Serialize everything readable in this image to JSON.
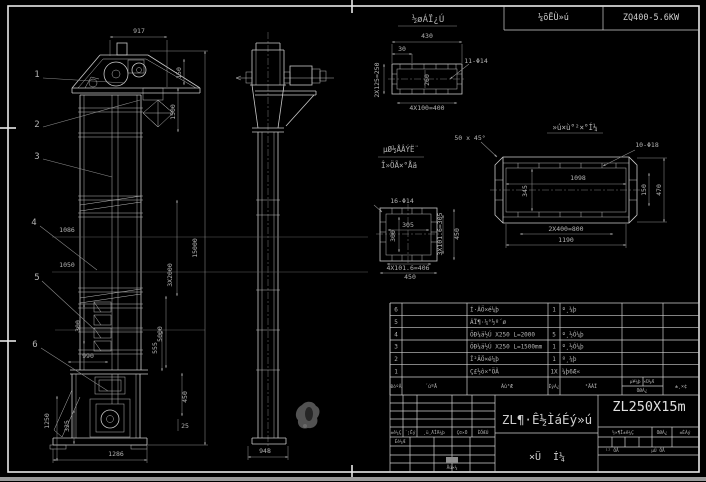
{
  "colors": {
    "background": "#000000",
    "frame": "#e8e8e8",
    "line": "#c9c9c9",
    "dim_line": "#8d8d8d",
    "text": "#b3b3b3",
    "accent_text": "#d9d9d9",
    "strip": "#9a9a9a",
    "blob": "#525252"
  },
  "header": {
    "reducer_label": "¼õËÙ»ú",
    "reducer_model": "ZQ400-5.6KW"
  },
  "view_titles": [
    {
      "t": "½øÁÏ¿Ú",
      "x": 428,
      "y": 22,
      "s": 9,
      "n": "detail-a-title"
    },
    {
      "t": "»ú×ù°²×°Í¼",
      "x": 575,
      "y": 130,
      "s": 7.5,
      "n": "detail-b-title"
    },
    {
      "t": "µØ½ÅÂÝË¨",
      "x": 401,
      "y": 152,
      "s": 7.5,
      "n": "detail-c-note-line1"
    },
    {
      "t": "Î»ÖÃ×°Åä",
      "x": 399,
      "y": 168,
      "s": 7.5,
      "n": "detail-c-note-line2"
    }
  ],
  "hole_notes": [
    {
      "t": "11-Φ14",
      "x": 476,
      "y": 63
    },
    {
      "t": "10-Φ18",
      "x": 647,
      "y": 147
    },
    {
      "t": "16-Φ14",
      "x": 402,
      "y": 203
    },
    {
      "t": "50 x 45°",
      "x": 470,
      "y": 140
    }
  ],
  "callouts": [
    {
      "t": "1",
      "x": 37,
      "y": 77
    },
    {
      "t": "2",
      "x": 37,
      "y": 127
    },
    {
      "t": "3",
      "x": 37,
      "y": 159
    },
    {
      "t": "4",
      "x": 34,
      "y": 225
    },
    {
      "t": "5",
      "x": 37,
      "y": 280
    },
    {
      "t": "6",
      "x": 35,
      "y": 347
    }
  ],
  "dimensions": [
    {
      "t": "917",
      "x": 139,
      "y": 33
    },
    {
      "t": "150",
      "x": 181,
      "y": 73,
      "r": -90
    },
    {
      "t": "1500",
      "x": 175,
      "y": 112,
      "r": -90
    },
    {
      "t": "15000",
      "x": 197,
      "y": 248,
      "r": -90
    },
    {
      "t": "3X2000",
      "x": 172,
      "y": 275,
      "r": -90
    },
    {
      "t": "5000",
      "x": 162,
      "y": 334,
      "r": -90
    },
    {
      "t": "1086",
      "x": 67,
      "y": 232
    },
    {
      "t": "1050",
      "x": 67,
      "y": 267
    },
    {
      "t": "990",
      "x": 88,
      "y": 358
    },
    {
      "t": "300",
      "x": 80,
      "y": 326,
      "r": -90
    },
    {
      "t": "1250",
      "x": 49,
      "y": 421,
      "r": -90
    },
    {
      "t": "325",
      "x": 69,
      "y": 426,
      "r": -90
    },
    {
      "t": "1286",
      "x": 116,
      "y": 456
    },
    {
      "t": "555",
      "x": 157,
      "y": 348,
      "r": -90
    },
    {
      "t": "450",
      "x": 187,
      "y": 397,
      "r": -90
    },
    {
      "t": "25",
      "x": 185,
      "y": 428
    },
    {
      "t": "948",
      "x": 265,
      "y": 453
    },
    {
      "t": "430",
      "x": 427,
      "y": 38
    },
    {
      "t": "30",
      "x": 402,
      "y": 51
    },
    {
      "t": "2X125=250",
      "x": 379,
      "y": 80,
      "r": -90
    },
    {
      "t": "260",
      "x": 429,
      "y": 80,
      "r": -90
    },
    {
      "t": "4X100=400",
      "x": 427,
      "y": 110
    },
    {
      "t": "1098",
      "x": 578,
      "y": 180
    },
    {
      "t": "345",
      "x": 527,
      "y": 191,
      "r": -90
    },
    {
      "t": "150",
      "x": 646,
      "y": 190,
      "r": -90
    },
    {
      "t": "470",
      "x": 661,
      "y": 190,
      "r": -90
    },
    {
      "t": "2X400=800",
      "x": 566,
      "y": 231
    },
    {
      "t": "1190",
      "x": 566,
      "y": 242
    },
    {
      "t": "305",
      "x": 408,
      "y": 227
    },
    {
      "t": "300",
      "x": 395,
      "y": 236,
      "r": -90
    },
    {
      "t": "3X101.6=305",
      "x": 442,
      "y": 234,
      "r": -90
    },
    {
      "t": "450",
      "x": 459,
      "y": 234,
      "r": -90
    },
    {
      "t": "4X101.6=406",
      "x": 408,
      "y": 270
    },
    {
      "t": "450",
      "x": 410,
      "y": 279
    }
  ],
  "bom": {
    "layout": {
      "left": 390,
      "right": 699,
      "top": 303,
      "header_top": 377,
      "bottom": 395,
      "cols": [
        390,
        402,
        467,
        548,
        560,
        622,
        663,
        699
      ],
      "weight_split_x": 643,
      "weight_split_y": 386,
      "no_x": 396,
      "name_x": 470,
      "qty_x": 554,
      "mat_x": 562
    },
    "headers": [
      {
        "t": "ÐòºÅ",
        "x": 396,
        "y": 388,
        "s": 4.5
      },
      {
        "t": "´úºÅ",
        "x": 431,
        "y": 388,
        "s": 5
      },
      {
        "t": "Ãû³Æ",
        "x": 507,
        "y": 388,
        "s": 5
      },
      {
        "t": "ÊýÁ¿",
        "x": 554,
        "y": 388,
        "s": 4.5
      },
      {
        "t": "²ÄÁÏ",
        "x": 591,
        "y": 388,
        "s": 5
      },
      {
        "t": "µ¥¼þ ×Ü¼Æ",
        "x": 642,
        "y": 383,
        "s": 4.5
      },
      {
        "t": "ÖØÁ¿",
        "x": 642,
        "y": 392,
        "s": 4.5
      },
      {
        "t": "±¸×¢",
        "x": 681,
        "y": 388,
        "s": 5
      }
    ],
    "rows": [
      {
        "no": "6",
        "code": "",
        "name": "Í·ÂÖ×é¼þ",
        "qty": "1",
        "mat": "º¸¼þ"
      },
      {
        "no": "5",
        "code": "",
        "name": "ÁÏ¶·¼°½º´ø",
        "qty": "",
        "mat": ""
      },
      {
        "no": "4",
        "code": "",
        "name": "ÖÐ¼ä½Ú X250 L=2000",
        "qty": "5",
        "mat": "º¸½Ó¼þ"
      },
      {
        "no": "3",
        "code": "",
        "name": "ÖÐ¼ä½Ú X250 L=1500mm",
        "qty": "1",
        "mat": "º¸½Ó¼þ"
      },
      {
        "no": "2",
        "code": "",
        "name": "Î²ÂÖ×é¼þ",
        "qty": "1",
        "mat": "º¸¼þ"
      },
      {
        "no": "1",
        "code": "",
        "name": "Ç£½ô×°ÖÃ",
        "qty": "1X",
        "mat": "¼þ6Æ«"
      }
    ]
  },
  "titleblock": {
    "machine_name": "ZL¶·Ê½ÌáÉý»ú",
    "model": "ZL250X15m",
    "drawing_type": "×Ü  Í¼",
    "labels": [
      {
        "t": "±ê¼Ç",
        "x": 396,
        "y": 434,
        "s": 4.5
      },
      {
        "t": "´¦Êý",
        "x": 410,
        "y": 434,
        "s": 4.5
      },
      {
        "t": "¸ü¸ÄÎÄ¼þ",
        "x": 434,
        "y": 434,
        "s": 4.5
      },
      {
        "t": "Ç©×Ö",
        "x": 462,
        "y": 434,
        "s": 4.5
      },
      {
        "t": "ÈÕÆÚ",
        "x": 483,
        "y": 434,
        "s": 4.5
      },
      {
        "t": "Éè¼Æ",
        "x": 400,
        "y": 443,
        "s": 4.5
      },
      {
        "t": "Åú×¼",
        "x": 452,
        "y": 469,
        "s": 4.5
      },
      {
        "t": "½×¶Î±ê¼Ç",
        "x": 623,
        "y": 434,
        "s": 4.5
      },
      {
        "t": "ÖØÁ¿",
        "x": 662,
        "y": 434,
        "s": 4.5
      },
      {
        "t": "±ÈÀý",
        "x": 685,
        "y": 434,
        "s": 4.5
      },
      {
        "t": "¹² ÕÅ",
        "x": 612,
        "y": 452,
        "s": 4.5
      },
      {
        "t": "µÚ ÕÅ",
        "x": 658,
        "y": 452,
        "s": 4.5
      }
    ]
  }
}
